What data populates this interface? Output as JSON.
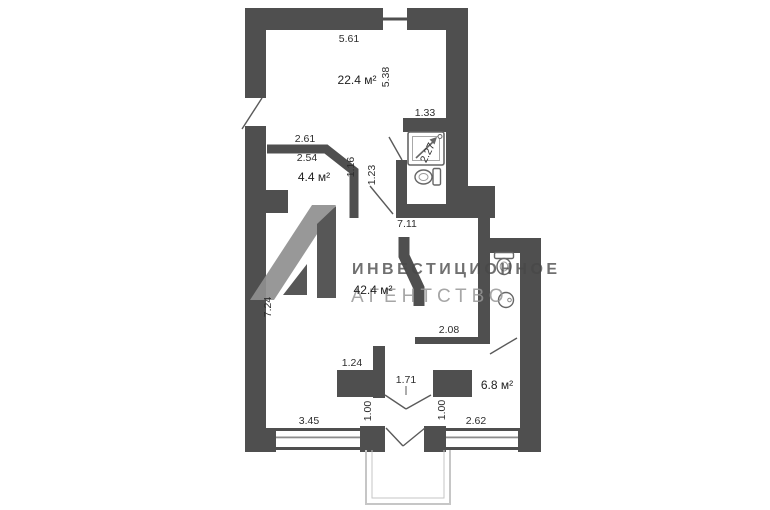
{
  "watermark": {
    "line1": "ИНВЕСТИЦИОННОЕ",
    "line2": "АГЕНТСТВО",
    "logo_icon": "l1-agency-logo"
  },
  "rooms": [
    {
      "id": "room-top",
      "area": "22.4 м²"
    },
    {
      "id": "room-nook",
      "area": "4.4 м²"
    },
    {
      "id": "room-main",
      "area": "42.4 м²"
    },
    {
      "id": "room-bottom-right",
      "area": "6.8 м²"
    }
  ],
  "dimensions": [
    {
      "id": "top-width",
      "text": "5.61"
    },
    {
      "id": "top-height",
      "text": "5.38"
    },
    {
      "id": "bath-width",
      "text": "1.33"
    },
    {
      "id": "nook-width-outer",
      "text": "2.61"
    },
    {
      "id": "nook-width-inner",
      "text": "2.54"
    },
    {
      "id": "nook-wall-height",
      "text": "1.16"
    },
    {
      "id": "hall-opening",
      "text": "1.23"
    },
    {
      "id": "bath-height",
      "text": "2.27"
    },
    {
      "id": "main-width",
      "text": "7.11"
    },
    {
      "id": "main-height",
      "text": "7.24"
    },
    {
      "id": "kitchen-wall",
      "text": "2.08"
    },
    {
      "id": "pier-width",
      "text": "1.24"
    },
    {
      "id": "balcony-door-width",
      "text": "1.71"
    },
    {
      "id": "pier-gap-left",
      "text": "1.00"
    },
    {
      "id": "pier-gap-right",
      "text": "1.00"
    },
    {
      "id": "window-right-width",
      "text": "2.62"
    },
    {
      "id": "window-left-width",
      "text": "3.45"
    }
  ],
  "fixtures": [
    {
      "id": "shower"
    },
    {
      "id": "toilet-bathroom"
    },
    {
      "id": "toilet-wc"
    },
    {
      "id": "sink-wc"
    }
  ],
  "colors": {
    "wall": "#4f4f4f",
    "dimension_text": "#2d2d2d",
    "window_line": "#8c8c8c",
    "balcony_line": "#c6c6c6",
    "watermark_dark": "#484848",
    "watermark_light": "#969696"
  }
}
